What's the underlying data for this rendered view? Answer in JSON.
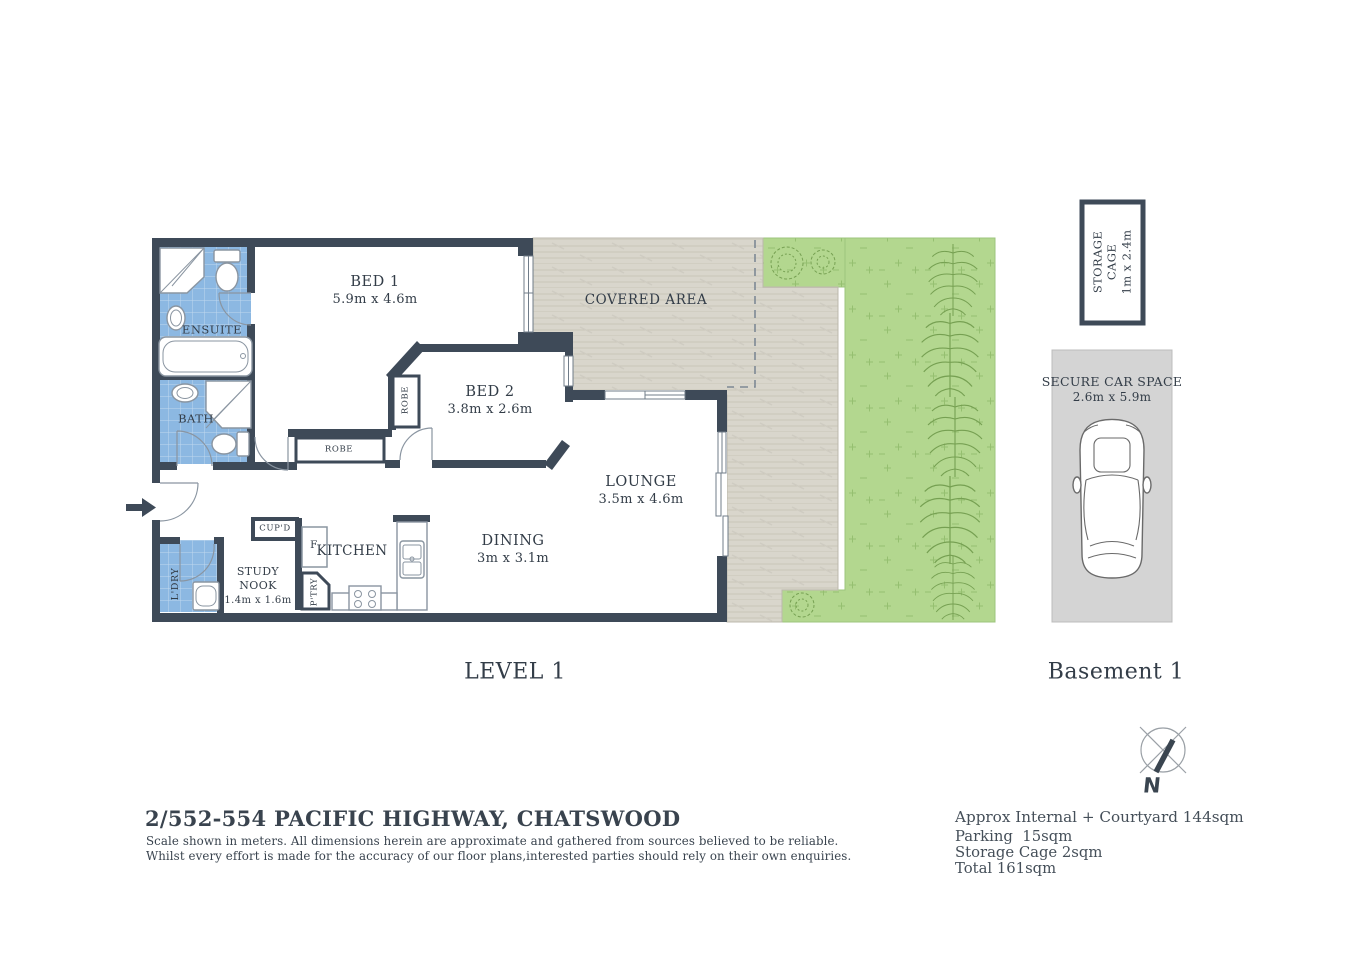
{
  "colors": {
    "wall": "#3e4a58",
    "wet_area_blue": "#8cb8e2",
    "garden_green": "#b3d78f",
    "deck_beige": "#d9d6cc",
    "carpark_gray": "#d4d4d4",
    "text": "#39434e"
  },
  "plan": {
    "level_label": "LEVEL 1",
    "covered_area": "COVERED AREA",
    "rooms": {
      "bed1": {
        "name": "BED 1",
        "dims": "5.9m x 4.6m"
      },
      "bed2": {
        "name": "BED 2",
        "dims": "3.8m x 2.6m"
      },
      "lounge": {
        "name": "LOUNGE",
        "dims": "3.5m x 4.6m"
      },
      "dining": {
        "name": "DINING",
        "dims": "3m x 3.1m"
      },
      "kitchen": {
        "name": "KITCHEN"
      },
      "study_nook": {
        "name": "STUDY NOOK",
        "dims": "1.4m x 1.6m"
      },
      "ensuite": {
        "name": "ENSUITE"
      },
      "bath": {
        "name": "BATH"
      },
      "laundry": {
        "name": "L'DRY"
      },
      "robe_bed2": {
        "name": "ROBE"
      },
      "robe_hall": {
        "name": "ROBE"
      },
      "cupboard": {
        "name": "CUP'D"
      },
      "pantry": {
        "name": "P'TRY"
      },
      "fridge": {
        "name": "F"
      }
    }
  },
  "basement": {
    "label": "Basement 1",
    "storage_cage": {
      "name": "STORAGE CAGE",
      "dims": "1m x 2.4m"
    },
    "car_space": {
      "name": "SECURE CAR SPACE",
      "dims": "2.6m x 5.9m"
    }
  },
  "compass": {
    "north": "N"
  },
  "footer": {
    "title": "2/552-554 PACIFIC HIGHWAY, CHATSWOOD",
    "disclaimer_line1": "Scale shown in meters. All dimensions herein are approximate and gathered from sources believed to be  reliable.",
    "disclaimer_line2": "Whilst every effort is made for the accuracy of our floor plans,interested parties should rely on their own enquiries."
  },
  "areas": {
    "internal_courtyard": "Approx Internal + Courtyard 144sqm",
    "parking": "Parking  15sqm",
    "storage": "Storage Cage 2sqm",
    "total": "Total 161sqm"
  }
}
